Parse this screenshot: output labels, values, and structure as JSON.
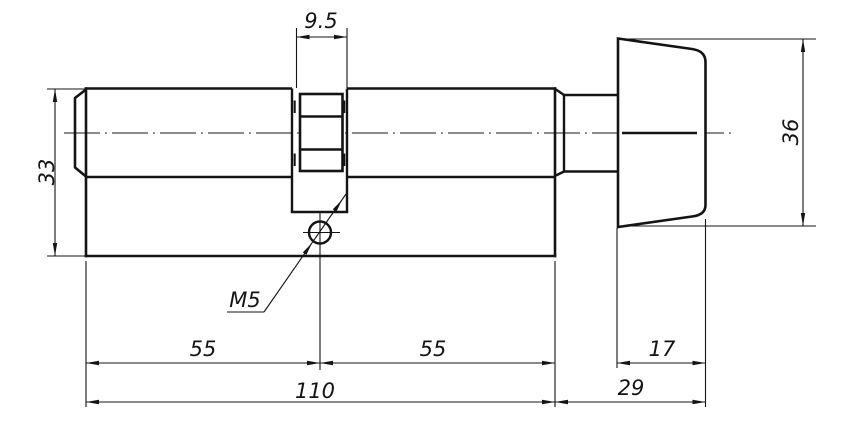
{
  "drawing": {
    "type": "technical-drawing",
    "subject": "euro profile lock cylinder with thumbturn knob, side view",
    "line_color": "#141414",
    "background_color": "#ffffff",
    "labels": {
      "cam_width": "9.5",
      "body_height": "33",
      "knob_height": "36",
      "thread_callout": "M5",
      "left_section": "55",
      "right_section": "55",
      "overall_length": "110",
      "knob_depth": "17",
      "knob_offset": "29"
    }
  }
}
